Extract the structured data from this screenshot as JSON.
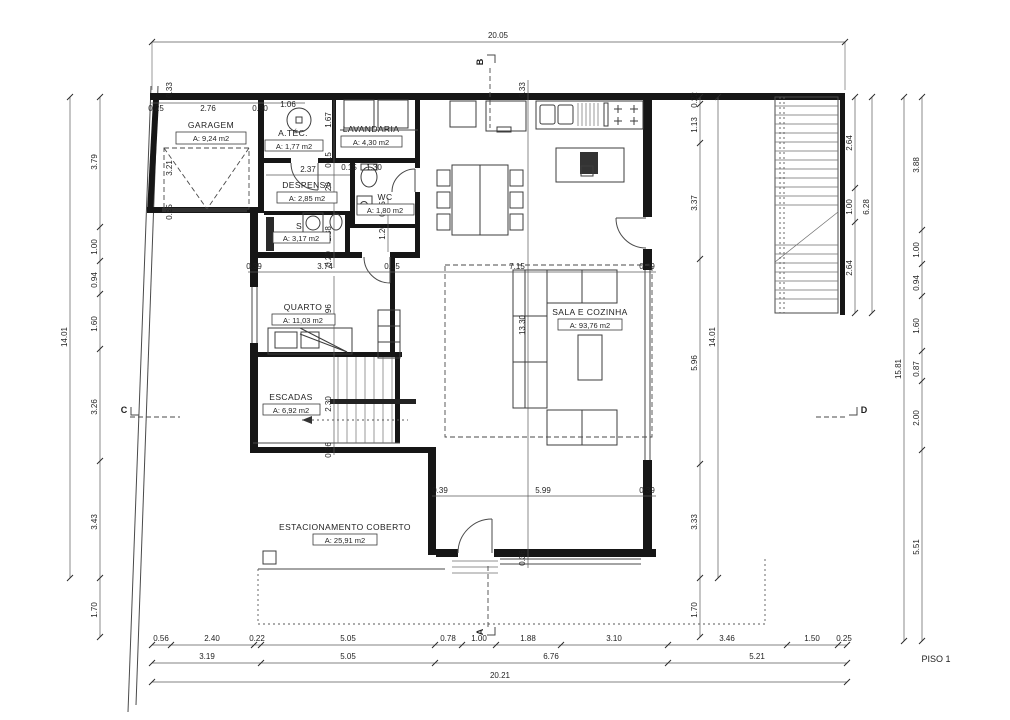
{
  "drawing": {
    "floor_label": "PISO 1",
    "rooms": {
      "garagem": {
        "name": "GARAGEM",
        "area": "A: 9,24 m2"
      },
      "atec": {
        "name": "A.TÉC.",
        "area": "A: 1,77 m2"
      },
      "lavandaria": {
        "name": "LAVANDARIA",
        "area": "A: 4,30 m2"
      },
      "despensa": {
        "name": "DESPENSA",
        "area": "A: 2,85 m2"
      },
      "wc": {
        "name": "WC",
        "area": "A: 1,80 m2"
      },
      "s": {
        "name": "S",
        "area": "A: 3,17 m2"
      },
      "quarto": {
        "name": "QUARTO",
        "area": "A: 11,03 m2"
      },
      "escadas": {
        "name": "ESCADAS",
        "area": "A: 6,92 m2"
      },
      "sala": {
        "name": "SALA E COZINHA",
        "area": "A: 93,76 m2"
      },
      "estacionamento": {
        "name": "ESTACIONAMENTO COBERTO",
        "area": "A: 25,91 m2"
      }
    },
    "markers": {
      "a": "A",
      "b": "B",
      "c": "C",
      "d": "D"
    },
    "dims": {
      "top_overall": "20.05",
      "bottom_overall": "20.21",
      "left_chain": [
        "3.79",
        "1.00",
        "0.94",
        "1.60",
        "3.26",
        "3.43",
        "1.70"
      ],
      "left_overall": "14.01",
      "right_chain": [
        "0.22",
        "1.13",
        "3.37",
        "5.96",
        "3.33",
        "1.70"
      ],
      "right_overall": "14.01",
      "stair_chain": [
        "2.64",
        "1.00",
        "2.64"
      ],
      "stair_overall": "6.28",
      "far_right_chain": [
        "3.88",
        "1.00",
        "0.94",
        "1.60",
        "0.87",
        "2.00",
        "5.51"
      ],
      "far_right_overall": "15.81",
      "bottom_row1": [
        "0.56",
        "2.40",
        "0.22",
        "5.05",
        "0.78",
        "1.00",
        "1.88",
        "3.10",
        "3.46",
        "1.50",
        "0.25"
      ],
      "bottom_row2": [
        "3.19",
        "5.05",
        "6.76",
        "5.21"
      ],
      "garage_top": [
        "0.25",
        "2.76",
        "0.30",
        "1.06"
      ],
      "garage_left": [
        "0.33",
        "3.21",
        "0.25"
      ],
      "mid_row": [
        "0.39",
        "3.74",
        "0.15",
        "7.15",
        "0.39"
      ],
      "lower_mid_row": [
        "0.39",
        "5.99",
        "0.39"
      ],
      "utility_col": [
        "1.67",
        "0.15",
        "1.20",
        "1.38",
        "0.20"
      ],
      "hall_col": [
        "0.15",
        "1.20"
      ],
      "wc_row": [
        "0.15",
        "1.30"
      ],
      "despensa_width": "2.37",
      "quarto_height": "2.96",
      "escadas_col": [
        "2.30",
        "0.36"
      ],
      "sala_col": [
        "0.33",
        "13.30",
        "0.36"
      ]
    }
  }
}
